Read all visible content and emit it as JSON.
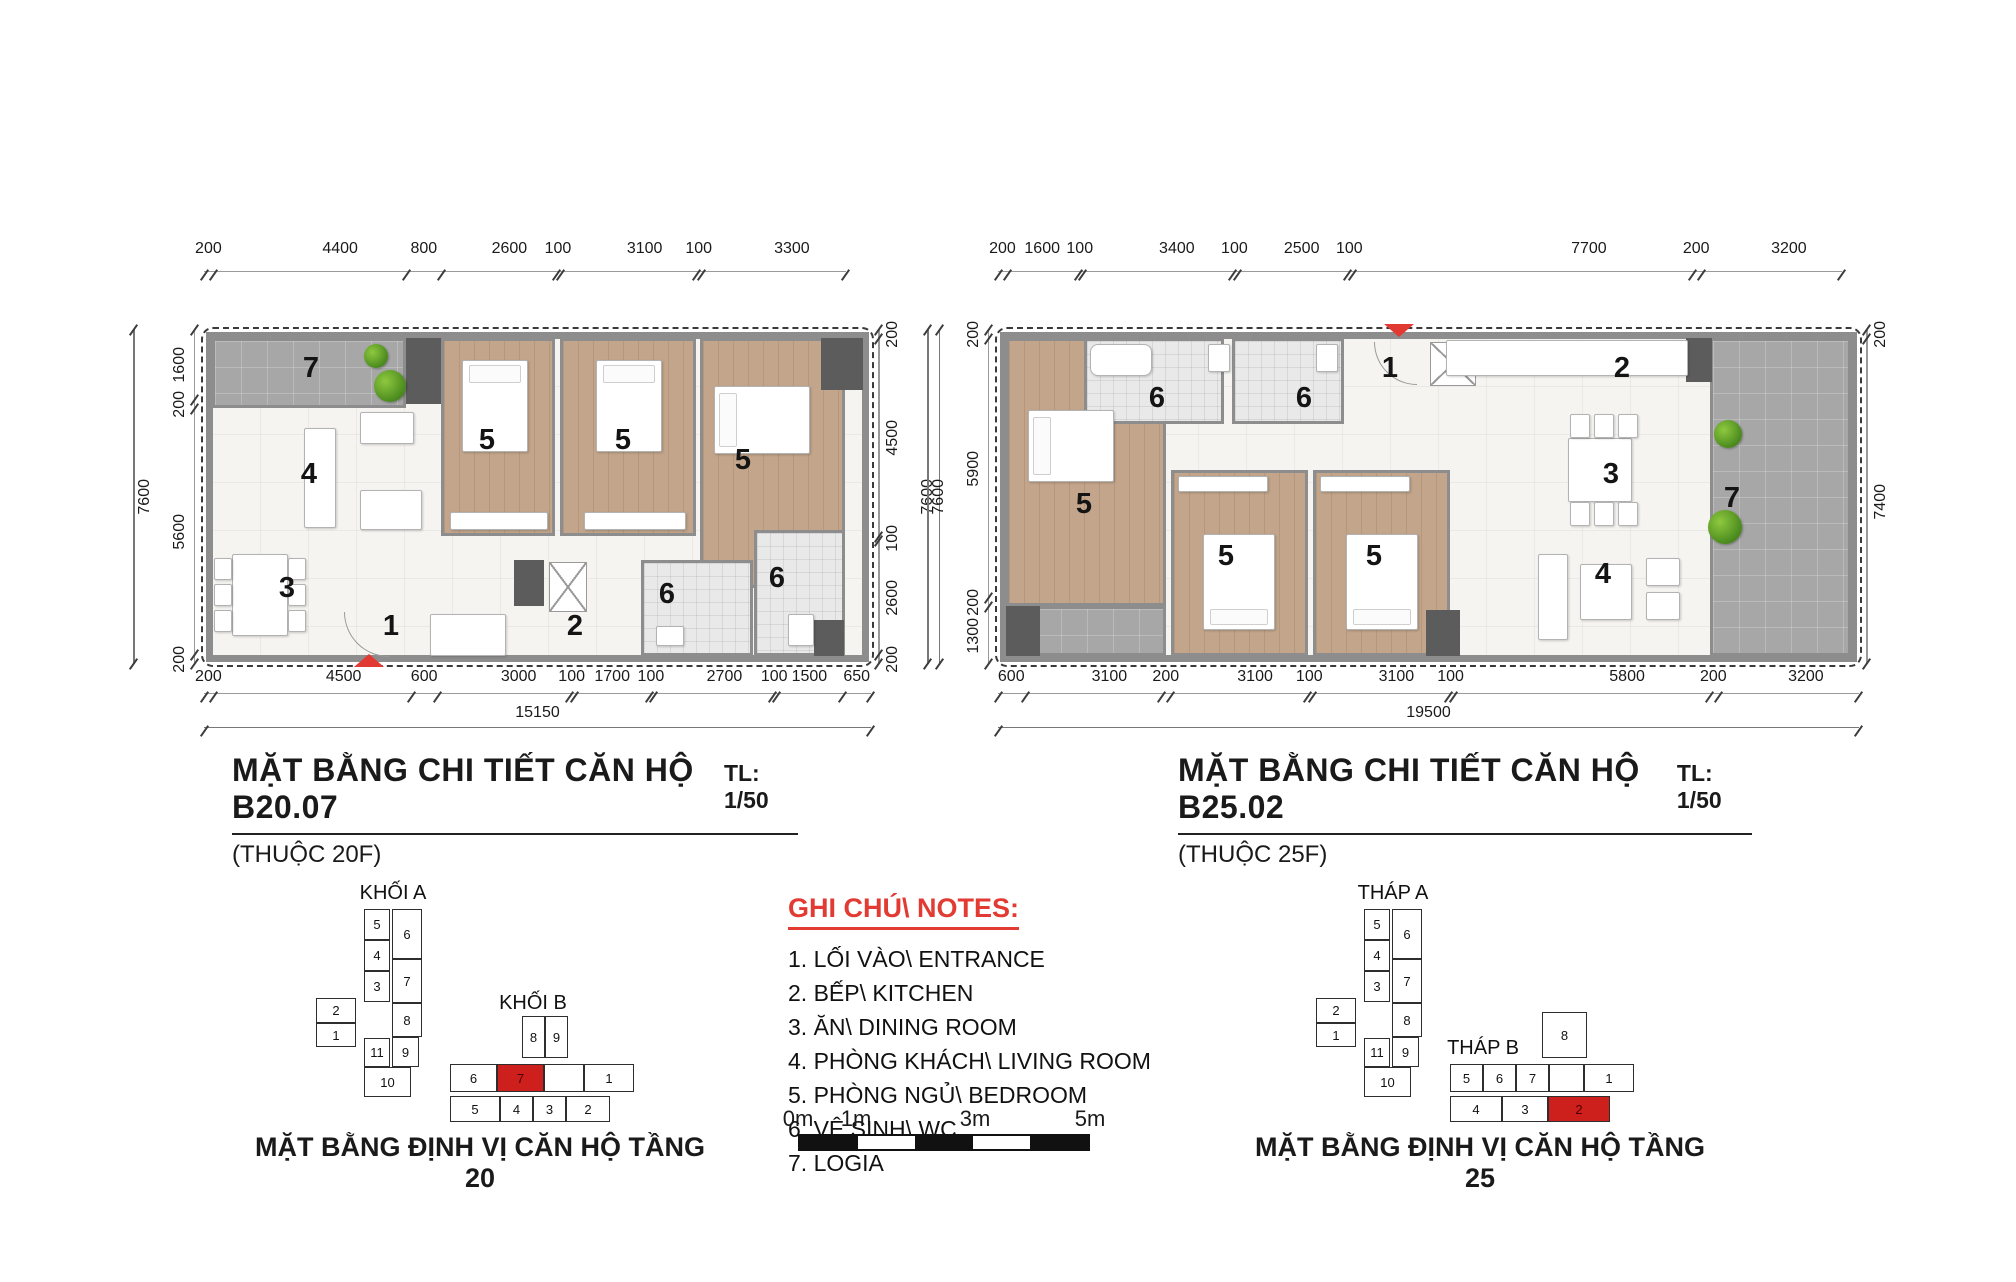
{
  "accent_red": "#e03a33",
  "plan_left": {
    "title": "MẶT BẰNG CHI TIẾT CĂN HỘ  B20.07",
    "scale_label": "TL: 1/50",
    "subtitle": "(THUỘC 20F)",
    "dims": {
      "top": [
        "200",
        "4400",
        "800",
        "2600",
        "100",
        "3100",
        "100",
        "3300"
      ],
      "bottom": [
        "200",
        "4500",
        "600",
        "3000",
        "100",
        "1700",
        "100",
        "2700",
        "100",
        "1500",
        "650"
      ],
      "bottom_total": "15150",
      "left": [
        "1600",
        "200",
        "5600",
        "200"
      ],
      "left_total": "7600",
      "right": [
        "200",
        "4500",
        "100",
        "2600",
        "200"
      ],
      "right_total": "7600"
    },
    "room_labels": [
      {
        "v": "7",
        "x": 92,
        "y": 22
      },
      {
        "v": "5",
        "x": 268,
        "y": 94
      },
      {
        "v": "5",
        "x": 404,
        "y": 94
      },
      {
        "v": "5",
        "x": 524,
        "y": 114
      },
      {
        "v": "4",
        "x": 90,
        "y": 128
      },
      {
        "v": "3",
        "x": 68,
        "y": 242
      },
      {
        "v": "1",
        "x": 172,
        "y": 280
      },
      {
        "v": "2",
        "x": 356,
        "y": 280
      },
      {
        "v": "6",
        "x": 448,
        "y": 248
      },
      {
        "v": "6",
        "x": 558,
        "y": 232
      }
    ]
  },
  "plan_right": {
    "title": "MẶT BẰNG CHI TIẾT CĂN HỘ B25.02",
    "scale_label": "TL: 1/50",
    "subtitle": "(THUỘC 25F)",
    "dims": {
      "top": [
        "200",
        "1600",
        "100",
        "3400",
        "100",
        "2500",
        "100",
        "7700",
        "200",
        "3200"
      ],
      "bottom": [
        "600",
        "3100",
        "200",
        "3100",
        "100",
        "3100",
        "100",
        "5800",
        "200",
        "3200"
      ],
      "bottom_total": "19500",
      "left": [
        "200",
        "5900",
        "200",
        "1300"
      ],
      "left_total": "7600",
      "right": [
        "200",
        "7400"
      ]
    },
    "room_labels": [
      {
        "v": "6",
        "x": 144,
        "y": 52
      },
      {
        "v": "6",
        "x": 291,
        "y": 52
      },
      {
        "v": "1",
        "x": 377,
        "y": 22
      },
      {
        "v": "2",
        "x": 609,
        "y": 22
      },
      {
        "v": "3",
        "x": 598,
        "y": 128
      },
      {
        "v": "7",
        "x": 719,
        "y": 152
      },
      {
        "v": "4",
        "x": 590,
        "y": 228
      },
      {
        "v": "5",
        "x": 71,
        "y": 158
      },
      {
        "v": "5",
        "x": 213,
        "y": 210
      },
      {
        "v": "5",
        "x": 361,
        "y": 210
      }
    ]
  },
  "legend": {
    "heading": "GHI CHÚ\\ NOTES:",
    "items": [
      "1. LỐI VÀO\\ ENTRANCE",
      "2. BẾP\\ KITCHEN",
      "3. ĂN\\ DINING ROOM",
      "4. PHÒNG KHÁCH\\ LIVING ROOM",
      "5. PHÒNG NGỦ\\ BEDROOM",
      "6. VỆ SINH\\ WC",
      "7. LOGIA"
    ]
  },
  "scalebar": {
    "labels": [
      {
        "v": "0m",
        "x": 0
      },
      {
        "v": "1m",
        "x": 58
      },
      {
        "v": "3m",
        "x": 177
      },
      {
        "v": "5m",
        "x": 292
      }
    ],
    "segments": [
      {
        "c": "#111111"
      },
      {
        "c": "#ffffff"
      },
      {
        "c": "#111111"
      },
      {
        "c": "#ffffff"
      },
      {
        "c": "#111111"
      }
    ]
  },
  "keyplan_left": {
    "tower_a_label": "KHỐI A",
    "tower_b_label": "KHỐI B",
    "caption": "MẶT BẰNG ĐỊNH VỊ CĂN HỘ TẦNG 20",
    "tower_a_cells": [
      {
        "v": "5",
        "x": 64,
        "y": 27,
        "w": 26,
        "h": 31
      },
      {
        "v": "4",
        "x": 64,
        "y": 58,
        "w": 26,
        "h": 31
      },
      {
        "v": "3",
        "x": 64,
        "y": 89,
        "w": 26,
        "h": 31
      },
      {
        "v": "6",
        "x": 92,
        "y": 27,
        "w": 30,
        "h": 50
      },
      {
        "v": "7",
        "x": 92,
        "y": 77,
        "w": 30,
        "h": 44
      },
      {
        "v": "8",
        "x": 92,
        "y": 121,
        "w": 30,
        "h": 34
      },
      {
        "v": "9",
        "x": 92,
        "y": 155,
        "w": 27,
        "h": 30
      },
      {
        "v": "2",
        "x": 16,
        "y": 116,
        "w": 40,
        "h": 25
      },
      {
        "v": "1",
        "x": 16,
        "y": 141,
        "w": 40,
        "h": 24
      },
      {
        "v": "11",
        "x": 64,
        "y": 156,
        "w": 26,
        "h": 29
      },
      {
        "v": "10",
        "x": 64,
        "y": 185,
        "w": 47,
        "h": 30
      }
    ],
    "tower_b_cells": [
      {
        "v": "8",
        "x": 222,
        "y": 134,
        "w": 23,
        "h": 42
      },
      {
        "v": "9",
        "x": 245,
        "y": 134,
        "w": 23,
        "h": 42
      },
      {
        "v": "6",
        "x": 150,
        "y": 182,
        "w": 47,
        "h": 28
      },
      {
        "v": "7",
        "x": 197,
        "y": 182,
        "w": 47,
        "h": 28,
        "red": true
      },
      {
        "v": "",
        "x": 244,
        "y": 182,
        "w": 40,
        "h": 28
      },
      {
        "v": "1",
        "x": 284,
        "y": 182,
        "w": 50,
        "h": 28
      },
      {
        "v": "5",
        "x": 150,
        "y": 214,
        "w": 50,
        "h": 26
      },
      {
        "v": "4",
        "x": 200,
        "y": 214,
        "w": 33,
        "h": 26
      },
      {
        "v": "3",
        "x": 233,
        "y": 214,
        "w": 33,
        "h": 26
      },
      {
        "v": "2",
        "x": 266,
        "y": 214,
        "w": 44,
        "h": 26
      }
    ]
  },
  "keyplan_right": {
    "tower_a_label": "THÁP A",
    "tower_b_label": "THÁP B",
    "caption": "MẶT BẰNG ĐỊNH VỊ CĂN HỘ TẦNG 25",
    "tower_a_cells": [
      {
        "v": "5",
        "x": 64,
        "y": 27,
        "w": 26,
        "h": 31
      },
      {
        "v": "4",
        "x": 64,
        "y": 58,
        "w": 26,
        "h": 31
      },
      {
        "v": "3",
        "x": 64,
        "y": 89,
        "w": 26,
        "h": 31
      },
      {
        "v": "6",
        "x": 92,
        "y": 27,
        "w": 30,
        "h": 50
      },
      {
        "v": "7",
        "x": 92,
        "y": 77,
        "w": 30,
        "h": 44
      },
      {
        "v": "8",
        "x": 92,
        "y": 121,
        "w": 30,
        "h": 34
      },
      {
        "v": "9",
        "x": 92,
        "y": 155,
        "w": 27,
        "h": 30
      },
      {
        "v": "2",
        "x": 16,
        "y": 116,
        "w": 40,
        "h": 25
      },
      {
        "v": "1",
        "x": 16,
        "y": 141,
        "w": 40,
        "h": 24
      },
      {
        "v": "11",
        "x": 64,
        "y": 156,
        "w": 26,
        "h": 29
      },
      {
        "v": "10",
        "x": 64,
        "y": 185,
        "w": 47,
        "h": 30
      }
    ],
    "tower_b_cells": [
      {
        "v": "8",
        "x": 242,
        "y": 130,
        "w": 45,
        "h": 46
      },
      {
        "v": "5",
        "x": 150,
        "y": 182,
        "w": 33,
        "h": 28
      },
      {
        "v": "6",
        "x": 183,
        "y": 182,
        "w": 33,
        "h": 28
      },
      {
        "v": "7",
        "x": 216,
        "y": 182,
        "w": 33,
        "h": 28
      },
      {
        "v": "",
        "x": 249,
        "y": 182,
        "w": 35,
        "h": 28
      },
      {
        "v": "1",
        "x": 284,
        "y": 182,
        "w": 50,
        "h": 28
      },
      {
        "v": "4",
        "x": 150,
        "y": 214,
        "w": 52,
        "h": 26
      },
      {
        "v": "3",
        "x": 202,
        "y": 214,
        "w": 46,
        "h": 26
      },
      {
        "v": "2",
        "x": 248,
        "y": 214,
        "w": 62,
        "h": 26,
        "red": true
      }
    ]
  }
}
